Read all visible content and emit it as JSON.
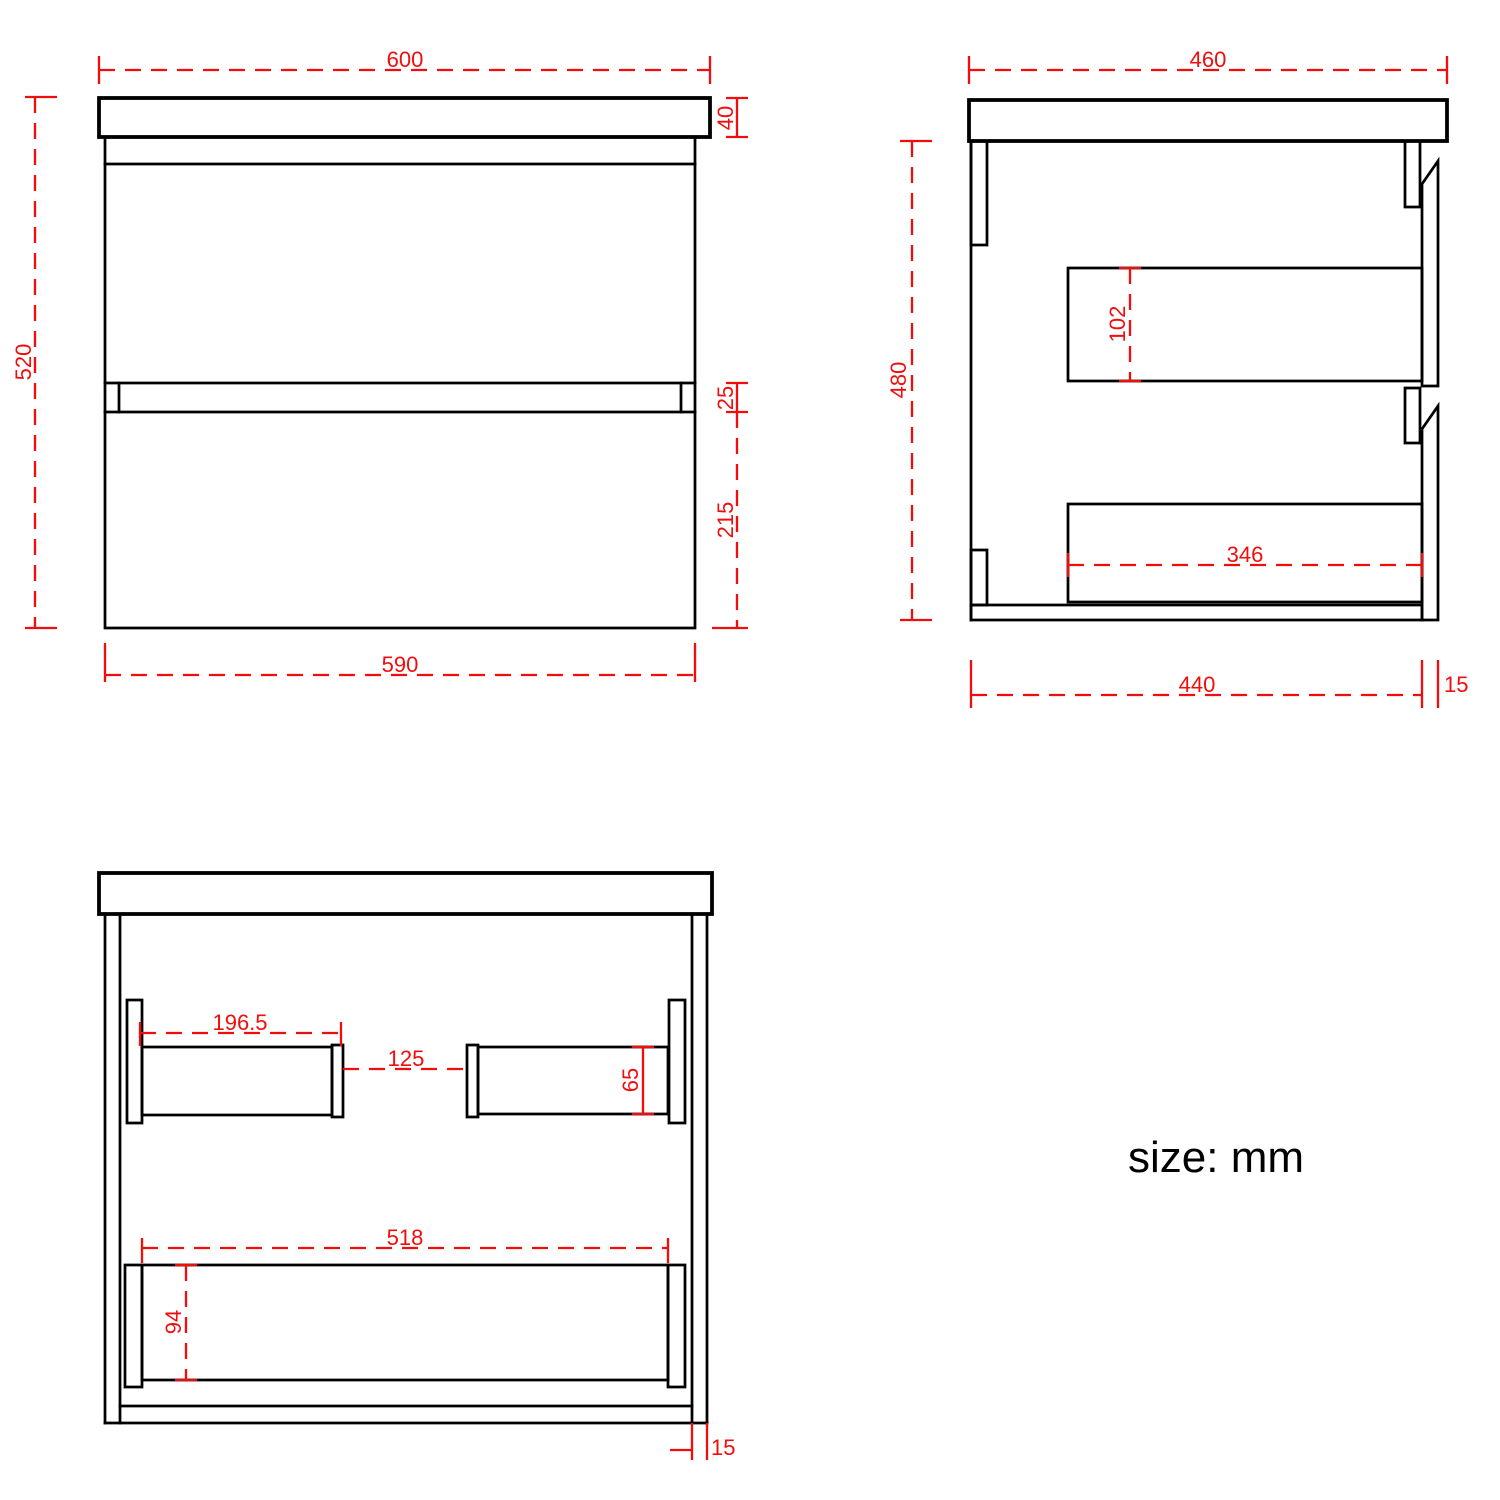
{
  "note": {
    "text": "size: mm"
  },
  "colors": {
    "line": "#000000",
    "dimension": "#f20d0d",
    "background": "#ffffff"
  },
  "views": {
    "front": {
      "label": "front-view",
      "dims": {
        "width_top": "600",
        "height_total": "520",
        "countertop_thickness": "40",
        "drawer_gap": "25",
        "lower_drawer_height": "215",
        "width_bottom": "590"
      }
    },
    "side": {
      "label": "side-view",
      "dims": {
        "depth_top": "460",
        "height_body": "480",
        "upper_drawer_depth": "102",
        "lower_drawer_depth": "346",
        "depth_bottom": "440",
        "front_panel_thickness": "15"
      }
    },
    "internal": {
      "label": "internal-front-view",
      "dims": {
        "left_rail_length": "196.5",
        "rail_gap": "125",
        "rail_height": "65",
        "lower_drawer_width": "518",
        "lower_drawer_height": "94",
        "bottom_panel_thickness": "15"
      }
    }
  }
}
